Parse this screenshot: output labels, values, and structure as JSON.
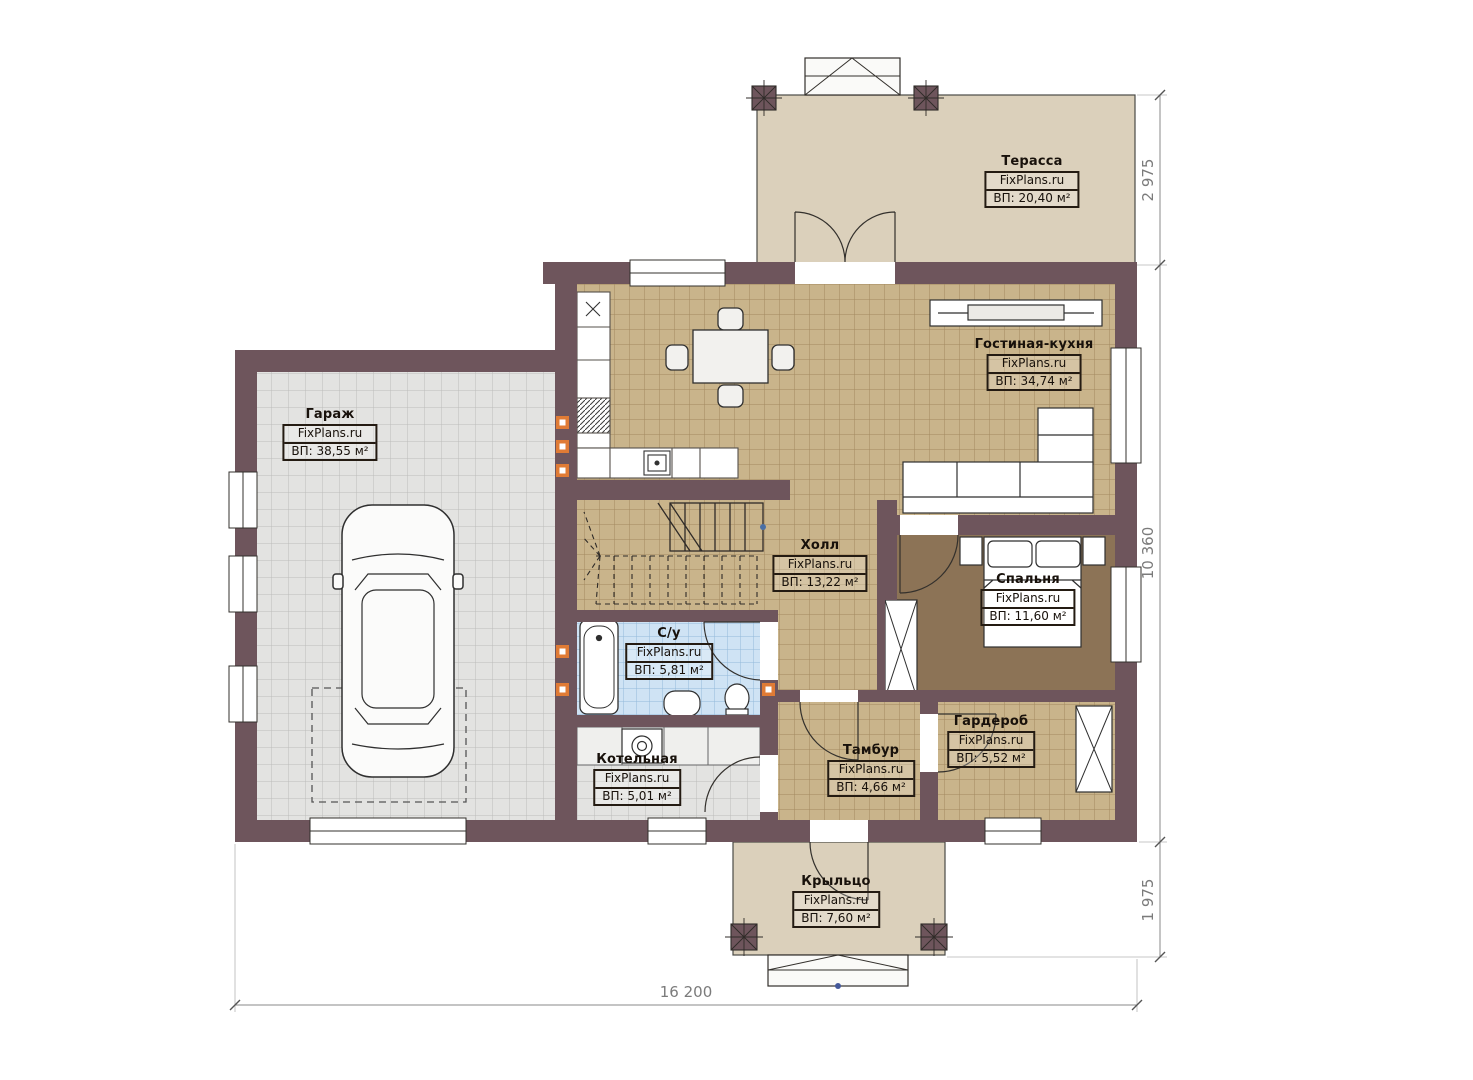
{
  "plan": {
    "site_watermark": "FixPlans.ru",
    "rooms": [
      {
        "id": "terrace",
        "name": "Терасса",
        "area": "ВП: 20,40 м²"
      },
      {
        "id": "garage",
        "name": "Гараж",
        "area": "ВП: 38,55 м²"
      },
      {
        "id": "living_kitchen",
        "name": "Гостиная-кухня",
        "area": "ВП: 34,74 м²"
      },
      {
        "id": "hall",
        "name": "Холл",
        "area": "ВП: 13,22 м²"
      },
      {
        "id": "bedroom",
        "name": "Спальня",
        "area": "ВП: 11,60 м²"
      },
      {
        "id": "bathroom",
        "name": "С/у",
        "area": "ВП: 5,81 м²"
      },
      {
        "id": "boiler",
        "name": "Котельная",
        "area": "ВП: 5,01 м²"
      },
      {
        "id": "vestibule",
        "name": "Тамбур",
        "area": "ВП: 4,66 м²"
      },
      {
        "id": "wardrobe",
        "name": "Гардероб",
        "area": "ВП: 5,52 м²"
      },
      {
        "id": "porch",
        "name": "Крыльцо",
        "area": "ВП: 7,60 м²"
      }
    ],
    "dimensions": {
      "right_top": "2 975",
      "right_middle": "10 360",
      "right_bottom": "1 975",
      "bottom": "16 200"
    },
    "colors": {
      "wall": "#6e555c",
      "terrace_floor": "#dbd0bb",
      "tile_tan": "#c9b48b",
      "tile_gray": "#e3e3e1",
      "tile_blue": "#cfe3f4",
      "bedroom_floor": "#8c7356",
      "accent_orange": "#e07b35"
    }
  }
}
